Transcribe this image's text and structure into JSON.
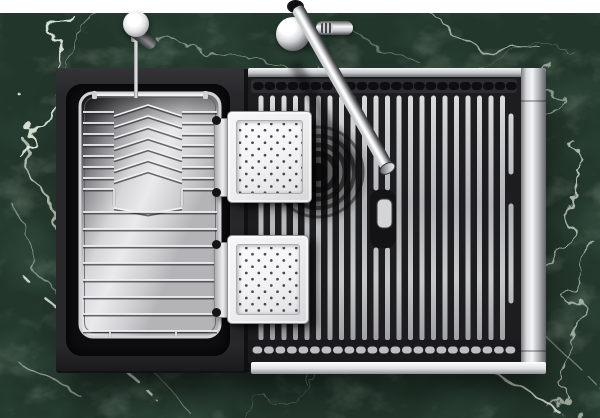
{
  "image_type": "product-photo",
  "subject": "Top-down view of a black workstation kitchen sink set into a green marble countertop",
  "visible_text": [],
  "objects": [
    {
      "name": "marble-countertop",
      "label": "green marble countertop with white veins"
    },
    {
      "name": "left-sink-deck",
      "label": "matte black sink deck (left section)"
    },
    {
      "name": "dish-drying-rack",
      "label": "stainless wire dish drying basket with chevron plate dividers"
    },
    {
      "name": "main-basin",
      "label": "black sink basin with stainless roll-up drying mat of vertical rods"
    },
    {
      "name": "drain-strainer",
      "label": "round drain with concentric rings behind the mat"
    },
    {
      "name": "mat-handle-slot",
      "label": "rounded handle cut-out in the drying mat"
    },
    {
      "name": "colander-tray-top",
      "label": "white perforated colander board (upper)"
    },
    {
      "name": "colander-tray-bottom",
      "label": "white perforated colander board (lower)"
    },
    {
      "name": "faucet",
      "label": "tall chrome kitchen faucet leaning over the basin, with side lever handle"
    },
    {
      "name": "soap-dispenser",
      "label": "chrome soap dispenser pump left of the faucet"
    },
    {
      "name": "sink-rim",
      "label": "brushed stainless steel sink rim on top, right and bottom edges"
    }
  ],
  "palette": {
    "white_backdrop": "#ffffff",
    "marble_base": "#23362b",
    "marble_dark": "#101d14",
    "marble_vein": "#e9f1e6",
    "marble_moss": "#7d9478",
    "deck_black": "#28282b",
    "basin_black": "#1d1d1f",
    "recess_black": "#0e0e10",
    "steel_hi": "#f4f5f7",
    "steel_mid": "#c3c4c8",
    "steel_lo": "#6e6f73",
    "rod_hi": "#d9dadc",
    "rod_lo": "#a2a3a6",
    "wire_bright": "#f0f1f3",
    "wire_dark": "#232326",
    "tick_dark": "#0e0e11",
    "tick_bright": "#cdced2",
    "tray_frame": "#ececee",
    "tray_face": "#f3f3f5",
    "dot_color": "#46474a",
    "chrome_white": "#ffffff",
    "chrome_dark": "#4e4f53",
    "drain_black": "#0a0a0b"
  }
}
